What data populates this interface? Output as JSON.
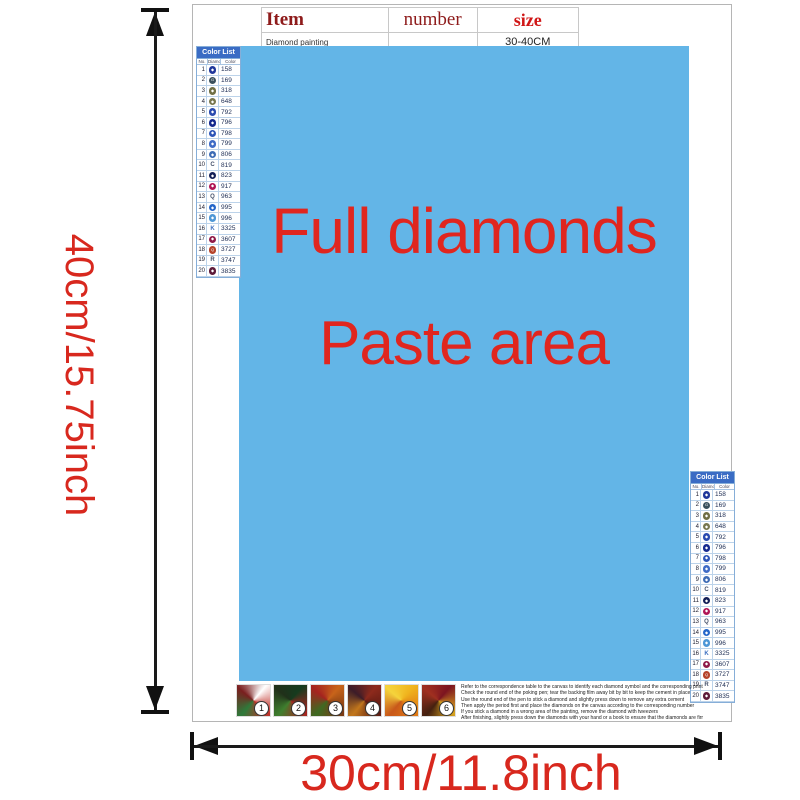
{
  "item_table": {
    "headers": [
      "Item",
      "number",
      "size"
    ],
    "row": {
      "item": "Diamond painting",
      "number": "",
      "size": "30-40CM"
    }
  },
  "paste_area": {
    "line1": "Full diamonds",
    "line2": "Paste area",
    "bg_color": "#63b5e7",
    "text_color": "#e0261f"
  },
  "dimensions": {
    "height_label": "40cm/15.75inch",
    "width_label": "30cm/11.8inch",
    "label_color": "#d8281e",
    "arrow_color": "#111111"
  },
  "color_list": {
    "title": "Color List",
    "columns": [
      "No.",
      "Diamond",
      "Color"
    ],
    "rows": [
      {
        "no": "1",
        "symbol": "◆",
        "type": "circle",
        "color": "#21389b",
        "code": "158"
      },
      {
        "no": "2",
        "symbol": "G",
        "type": "circle",
        "color": "#39505c",
        "code": "169"
      },
      {
        "no": "3",
        "symbol": "◆",
        "type": "circle",
        "color": "#6f6f45",
        "code": "318"
      },
      {
        "no": "4",
        "symbol": "◆",
        "type": "circle",
        "color": "#77774f",
        "code": "648"
      },
      {
        "no": "5",
        "symbol": "◆",
        "type": "circle",
        "color": "#2a4bb0",
        "code": "792"
      },
      {
        "no": "6",
        "symbol": "◆",
        "type": "circle",
        "color": "#162a8f",
        "code": "796"
      },
      {
        "no": "7",
        "symbol": "◆",
        "type": "circle",
        "color": "#2d55b8",
        "code": "798"
      },
      {
        "no": "8",
        "symbol": "◆",
        "type": "circle",
        "color": "#3f6cc6",
        "code": "799"
      },
      {
        "no": "9",
        "symbol": "◆",
        "type": "circle",
        "color": "#3e6cb5",
        "code": "806"
      },
      {
        "no": "10",
        "symbol": "C",
        "type": "letter",
        "color": "#44506a",
        "code": "819"
      },
      {
        "no": "11",
        "symbol": "◆",
        "type": "circle",
        "color": "#131f57",
        "code": "823"
      },
      {
        "no": "12",
        "symbol": "◆",
        "type": "circle",
        "color": "#b01656",
        "code": "917"
      },
      {
        "no": "13",
        "symbol": "Q",
        "type": "letter",
        "color": "#44506a",
        "code": "963"
      },
      {
        "no": "14",
        "symbol": "◆",
        "type": "circle",
        "color": "#2667c9",
        "code": "995"
      },
      {
        "no": "15",
        "symbol": "◆",
        "type": "circle",
        "color": "#4e97d6",
        "code": "996"
      },
      {
        "no": "16",
        "symbol": "K",
        "type": "letter",
        "color": "#3c6fc0",
        "code": "3325"
      },
      {
        "no": "17",
        "symbol": "◆",
        "type": "circle",
        "color": "#8f1a49",
        "code": "3607"
      },
      {
        "no": "18",
        "symbol": "Q",
        "type": "circle",
        "color": "#b5432b",
        "code": "3727"
      },
      {
        "no": "19",
        "symbol": "R",
        "type": "letter",
        "color": "#44506a",
        "code": "3747"
      },
      {
        "no": "20",
        "symbol": "◆",
        "type": "circle",
        "color": "#5d1b3a",
        "code": "3835"
      }
    ]
  },
  "steps": [
    {
      "num": "1",
      "colors": [
        "#ffffff",
        "#c03028",
        "#2e7a3a",
        "#7a1f1f"
      ]
    },
    {
      "num": "2",
      "colors": [
        "#153b1e",
        "#a82420",
        "#3f7f2e",
        "#20301a"
      ]
    },
    {
      "num": "3",
      "colors": [
        "#c8641a",
        "#7c3a14",
        "#3e6a22",
        "#a5231f"
      ]
    },
    {
      "num": "4",
      "colors": [
        "#8e2a1c",
        "#5a1a12",
        "#c2771c",
        "#3c1c28"
      ]
    },
    {
      "num": "5",
      "colors": [
        "#f0b41e",
        "#e07a14",
        "#c8581a",
        "#f5d43c"
      ]
    },
    {
      "num": "6",
      "colors": [
        "#7c1420",
        "#d8a41e",
        "#44200f",
        "#a03020"
      ]
    }
  ],
  "instructions": {
    "lines": [
      "Refer to the correspondence table to the canvas to identify each diamond symbol and the corresponding printed number on the canvas",
      "Check the round end of the poking pen; tear the backing film away bit by bit to keep the cement in place",
      "Use the round end of the pen to stick a diamond and slightly press down to remove any extra cement",
      "Then apply the period first and place the diamonds on the canvas according to the corresponding number",
      "If you stick a diamond in a wrong area of the painting, remove the diamond with tweezers",
      "After finishing, slightly press down the diamonds with your hand or a book to ensure that the diamonds are firmly attached"
    ]
  }
}
